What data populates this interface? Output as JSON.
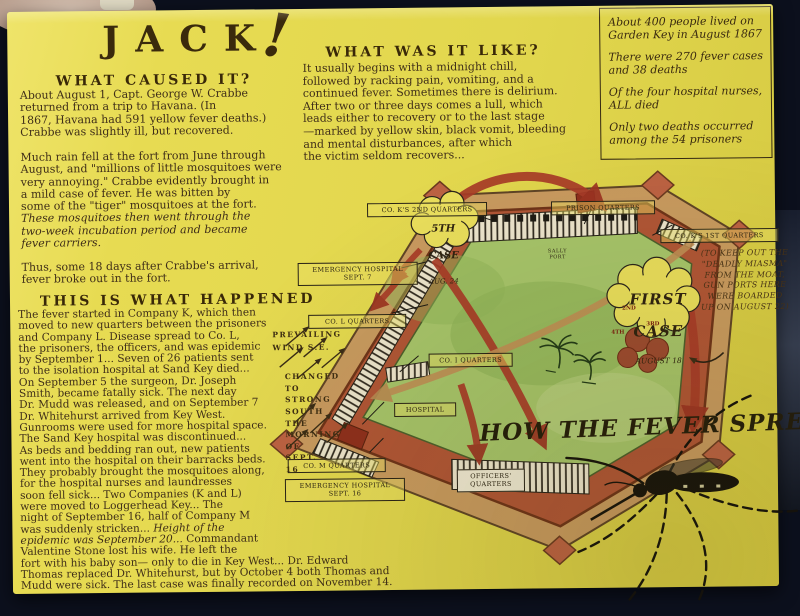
{
  "poster": {
    "title": "JACK",
    "title_bang": "!"
  },
  "sections": {
    "caused": {
      "heading": "WHAT CAUSED IT?",
      "p1": "About August 1, Capt. George W. Crabbe\nreturned from a trip to Havana.  (In\n1867, Havana had 591 yellow fever deaths.)\nCrabbe was slightly ill, but recovered.",
      "p2": "Much rain fell at the fort from June through\nAugust, and \"millions of little mosquitoes were\nvery annoying.\"  Crabbe evidently brought in\na mild case of fever.  He was bitten by\nsome of the \"tiger\" mosquitoes at the fort.",
      "p2_italic": "These mosquitoes then went through the\ntwo-week incubation period and became\nfever carriers.",
      "p3": "Thus, some 18 days after Crabbe's arrival,\nfever broke out in the fort."
    },
    "like": {
      "heading": "WHAT WAS IT LIKE?",
      "body": "It usually begins with a midnight chill,\nfollowed by racking pain, vomiting, and a\ncontinued fever. Sometimes there is delirium.\nAfter two or three days comes a lull, which\nleads either to recovery or to the last stage\n—marked by yellow skin, black vomit, bleeding\nand mental disturbances, after which\nthe victim seldom recovers..."
    },
    "facts": {
      "items": [
        "About 400 people lived on\nGarden Key in August 1867",
        "There were 270 fever cases\nand 38 deaths",
        "Of the four hospital nurses,\nALL died",
        "Only two deaths occurred\namong the 54 prisoners"
      ]
    },
    "happened": {
      "heading": "THIS IS WHAT HAPPENED",
      "part1": "The fever started in Company K, which then\nmoved to new quarters between the prisoners\nand Company L.  Disease spread to Co. L,\nthe prisoners, the officers, and was epidemic\nby September 1... Seven of 26 patients sent\nto the isolation hospital at Sand Key died...\nOn September 5 the surgeon,  Dr. Joseph\nSmith, became fatally sick.  The next day\nDr. Mudd was released, and on September 7\nDr. Whitehurst arrived from  Key  West.\nGunrooms were used for more hospital space.\nThe Sand Key hospital was discontinued...\nAs beds and bedding ran out,  new patients\nwent into the hospital on their barracks beds.\nThey probably brought the mosquitoes along,\nfor the hospital nurses and laundresses\nsoon fell sick...  Two Companies (K and L)\nwere moved to  Loggerhead Key...   The\nnight of September 16, half of Company M\nwas suddenly stricken...  ",
      "part2_italic": "Height of the\nepidemic was September 20...  ",
      "part3": "Commandant\nValentine Stone lost his wife.  He left the\nfort with his baby son— only to die in Key West...   Dr. Edward\nThomas replaced Dr. Whitehurst, but by October 4  both  Thomas and\nMudd were sick.  The last case was finally recorded on November 14."
    }
  },
  "diagram": {
    "labels": [
      {
        "id": "co-k-2nd",
        "text": "CO. K'S 2ND QUARTERS"
      },
      {
        "id": "prison",
        "text": "PRISON QUARTERS"
      },
      {
        "id": "co-k-1st",
        "text": "CO. K'S 1ST QUARTERS"
      },
      {
        "id": "emergency-7",
        "text": "EMERGENCY HOSPITAL\nSEPT. 7"
      },
      {
        "id": "co-l",
        "text": "CO. L QUARTERS"
      },
      {
        "id": "co-i",
        "text": "CO. I QUARTERS"
      },
      {
        "id": "hospital",
        "text": "HOSPITAL"
      },
      {
        "id": "co-m",
        "text": "CO. M QUARTERS"
      },
      {
        "id": "emergency-16",
        "text": "EMERGENCY HOSPITAL\nSEPT. 16"
      },
      {
        "id": "officers",
        "text": "OFFICERS'\nQUARTERS"
      }
    ],
    "clouds": [
      {
        "id": "fifth-case",
        "line1": "5TH",
        "line2": "CASE",
        "line3": "AUG. 24"
      },
      {
        "id": "first-case",
        "line1": "FIRST",
        "line2": "CASE",
        "line3": "AUGUST 18"
      }
    ],
    "note_gunports": "(TO KEEP OUT THE\n\"DEADLY MIASMA\"\nFROM THE MOAT,\nGUN PORTS HERE\nWERE BOARDED\nUP ON AUGUST 22)",
    "wind_line1": "PREVAILING\nWIND  S.E.",
    "wind_line2": "CHANGED\nTO\nSTRONG\nSOUTH\nTHE\nMORNING\nOF\nSEPT.\n16",
    "caption": "HOW THE FEVER SPREAD",
    "sally_port": "SALLY\nPORT",
    "case_markers": [
      "2ND",
      "3RD",
      "4TH"
    ],
    "colors": {
      "arrow_red": "#a83b28",
      "wall_brick": "#b05536",
      "moat_sand": "#c89a5f",
      "parade_green": "#a6c46a"
    }
  }
}
